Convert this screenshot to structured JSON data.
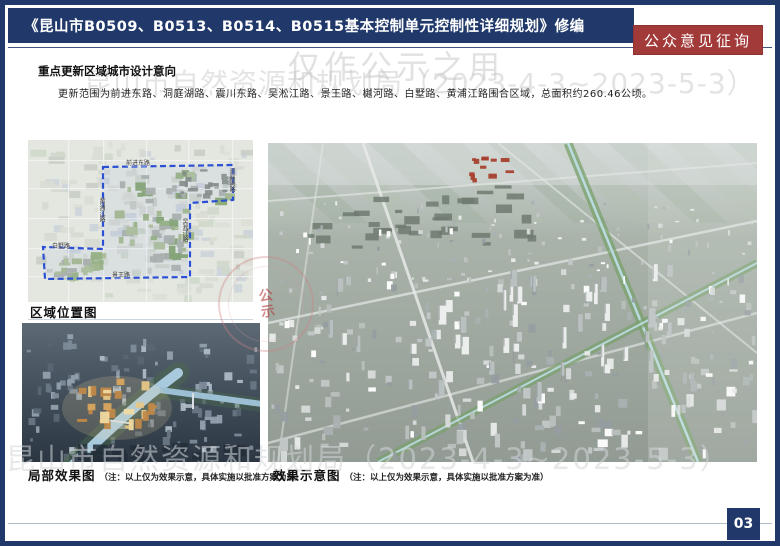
{
  "header": {
    "title": "《昆山市B0509、B0513、B0514、B0515基本控制单元控制性详细规划》修编",
    "badge": "公众意见征询"
  },
  "watermarks": {
    "top_line1": "仅作公示之用",
    "bureau_period": "昆山市自然资源和规划局（2023-4-3~2023-5-3）",
    "seal_text": "公示"
  },
  "section": {
    "heading": "重点更新区域城市设计意向",
    "body": "更新范围为前进东路、洞庭湖路、震川东路、吴淞江路、景王路、樾河路、白墅路、黄浦江路围合区域，总面积约260.46公顷。"
  },
  "figures": {
    "location_map": {
      "label": "区域位置图",
      "roads": {
        "top": "前进东路",
        "right": "吴淞江路",
        "left": "黄浦江路",
        "bottom": "景王路",
        "left_notch": "白墅路",
        "top_right": "洞庭湖路"
      }
    },
    "local_render": {
      "label": "局部效果图",
      "note": "（注：以上仅为效果示意，具体实施以批准方案为准）"
    },
    "overall_render": {
      "label": "效果示意图",
      "note": "（注：以上仅为效果示意，具体实施以批准方案为准）"
    }
  },
  "footer": {
    "page_number": "03"
  },
  "colors": {
    "navy": "#20396a",
    "badge_red": "#a23a3a",
    "boundary_blue": "#2b50d4",
    "watermark_gray": "#c9c9c9"
  }
}
